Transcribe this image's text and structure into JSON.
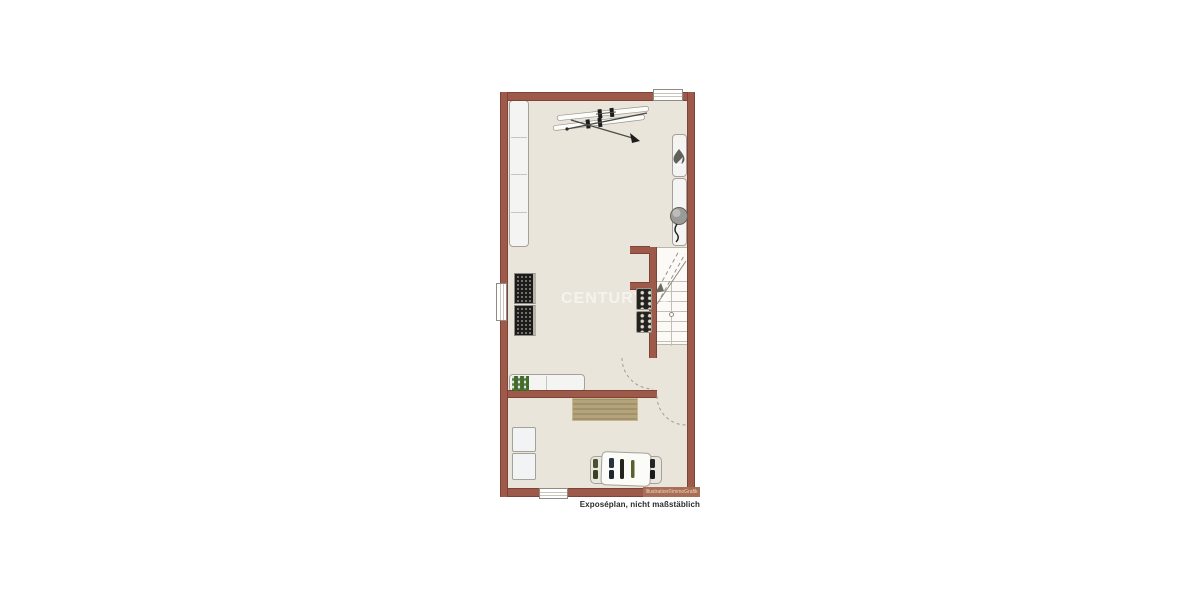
{
  "canvas": {
    "background": "#ffffff"
  },
  "floorplan": {
    "caption": "Exposéplan, nicht maßstäblich",
    "watermark": "CENTURY 21",
    "credit": "Illustration©immoGrafik",
    "colors": {
      "wall": "#9d5a4a",
      "wall_outline": "#7e4336",
      "floor": "#e9e5da",
      "stair_floor": "#fbfaf7",
      "rug": "#b4a47b",
      "furniture_light": "#f4f4f2",
      "dark_shelf": "#1b1b19",
      "plant_green": "#44702c",
      "credit_badge_bg": "#a96e55"
    },
    "icons": [
      {
        "name": "skis-icon",
        "meaning": "pair of skis with two ski poles on floor"
      },
      {
        "name": "flame-icon",
        "meaning": "heater / boiler flame symbol"
      },
      {
        "name": "boiler-tank-icon",
        "meaning": "round water tank with cable, top view"
      },
      {
        "name": "stair-direction-arrow",
        "meaning": "dashed arrow showing stair up direction"
      },
      {
        "name": "door-swing-arc",
        "meaning": "dashed quarter-circle door swing"
      },
      {
        "name": "plant-icon",
        "meaning": "small potted plant on sideboard"
      }
    ],
    "furniture": [
      {
        "name": "wardrobe-row"
      },
      {
        "name": "heater-unit"
      },
      {
        "name": "boiler-unit"
      },
      {
        "name": "storage-shelf-upper"
      },
      {
        "name": "storage-shelf-lower"
      },
      {
        "name": "beverage-crate-upper"
      },
      {
        "name": "beverage-crate-lower"
      },
      {
        "name": "sideboard"
      },
      {
        "name": "doormat"
      },
      {
        "name": "washer-upper"
      },
      {
        "name": "washer-lower"
      },
      {
        "name": "shoe-bench"
      }
    ],
    "rooms": [
      {
        "name": "main-cellar-room"
      },
      {
        "name": "staircase"
      },
      {
        "name": "lower-cellar-room"
      }
    ]
  }
}
